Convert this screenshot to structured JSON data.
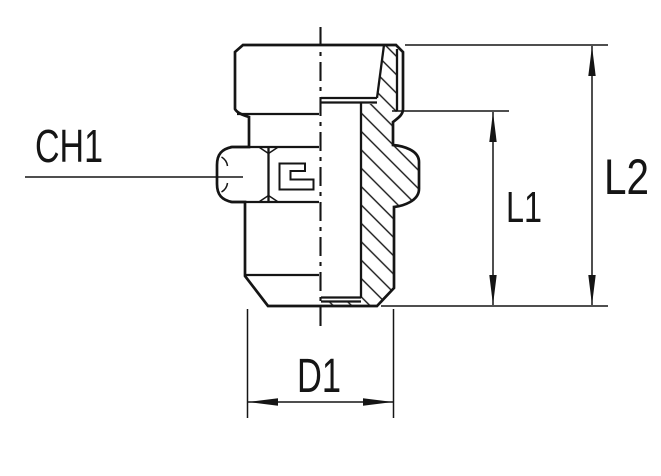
{
  "page": {
    "background": "#ffffff"
  },
  "drawing": {
    "type": "technical-drawing-half-section",
    "line_color": "#151515",
    "labels": {
      "ch1": "CH1",
      "l1": "L1",
      "l2": "L2",
      "d1": "D1"
    }
  }
}
